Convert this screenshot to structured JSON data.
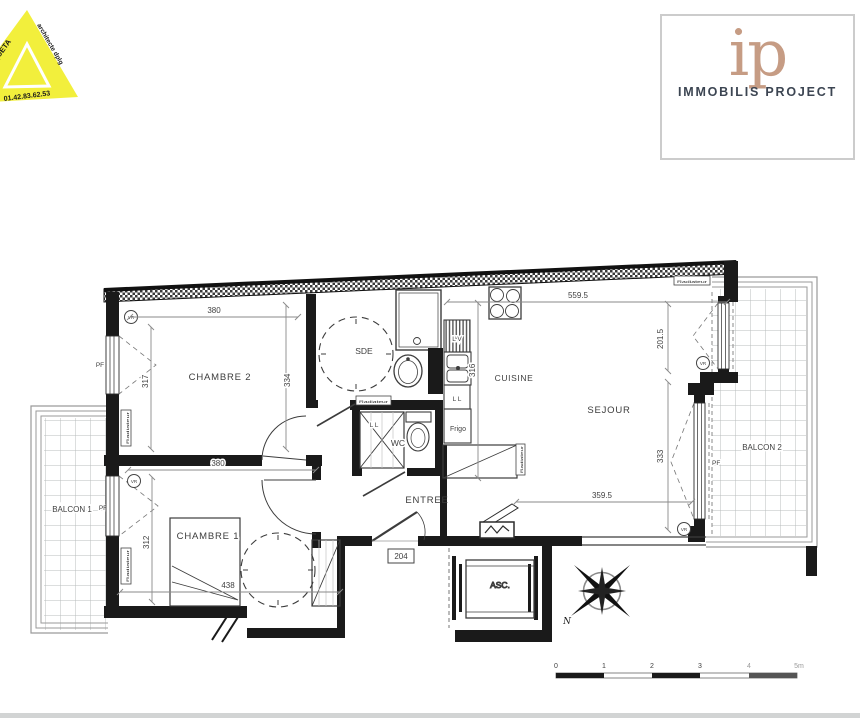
{
  "stamp": {
    "architect": "RC ROQUETA",
    "title": "architecte dplg",
    "phone": "01.42.83.62.53"
  },
  "logo": {
    "monogram": "ip",
    "company": "IMMOBILIS PROJECT"
  },
  "unit": {
    "number": "204"
  },
  "rooms": {
    "chambre2": "CHAMBRE 2",
    "sde": "SDE",
    "cuisine": "CUISINE",
    "sejour": "SEJOUR",
    "entree": "ENTREE",
    "wc": "WC",
    "chambre1": "CHAMBRE 1",
    "balcon1": "BALCON 1",
    "balcon2": "BALCON 2",
    "asc": "ASC."
  },
  "dims": {
    "chambre2_width": "380",
    "chambre2_left": "317",
    "chambre2_right": "334",
    "cuisine_height": "316",
    "sejour_top": "559.5",
    "sejour_right_upper": "201.5",
    "sejour_right_lower": "333",
    "sejour_bottom": "359.5",
    "chambre1_width": "380",
    "chambre1_left": "312",
    "chambre1_bottom": "438"
  },
  "fixtures": {
    "frigo": "Frigo",
    "lave_linge": "L L",
    "lave_vaisselle": "L V",
    "radiateur": "Radiateur"
  },
  "openings": {
    "pf": "PF",
    "vr": "VR"
  },
  "compass": {
    "north": "N"
  },
  "scalebar": {
    "ticks": [
      "0",
      "1",
      "2",
      "3",
      "4"
    ],
    "last": "5m"
  }
}
